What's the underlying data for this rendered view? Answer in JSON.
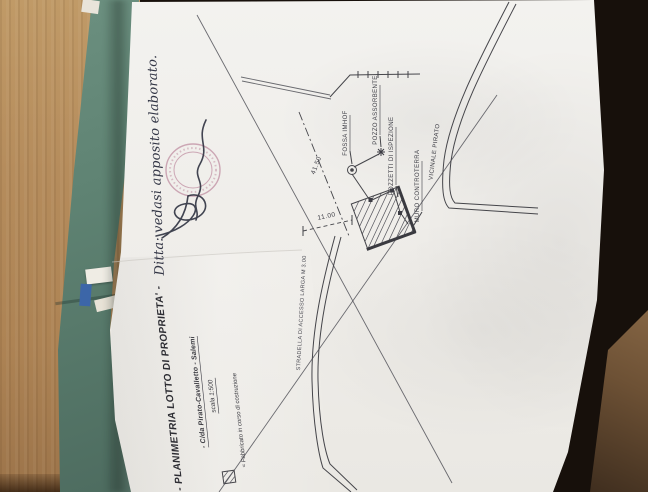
{
  "handwritten_note": "Ditta: vedasi apposito elaborato.",
  "plan_labels": {
    "fossa_imhoff": "FOSSA IMHOF",
    "pozzo_assorbente": "POZZO ASSORBENTE",
    "pozzetti_ispezione": "POZZETTI DI ISPEZIONE",
    "muro_controterra": "MURO CONTROTERRA",
    "road": "VICINALE PIRATO",
    "access_road": "STRADELLA DI ACCESSO LARGA M 3.00"
  },
  "dimensions": {
    "lot_side": "41.50",
    "building_side": "11.00"
  },
  "title_block": {
    "title": "- PLANIMETRIA LOTTO DI PROPRIETA' -",
    "location": "- C/da Pirato-Cavalletto - Salemi",
    "scale": "scala 1:500",
    "legend": "= Fabbricato in corso di costruzione"
  },
  "colors": {
    "desk_wood": "#b3885a",
    "desk_shadow": "#17100b",
    "folder_green": "#5f8373",
    "paper_white": "#f1efec",
    "drawing_ink": "#45454a",
    "stamp_pink": "#a85f7e",
    "pen_ink": "#2a2d3c"
  }
}
